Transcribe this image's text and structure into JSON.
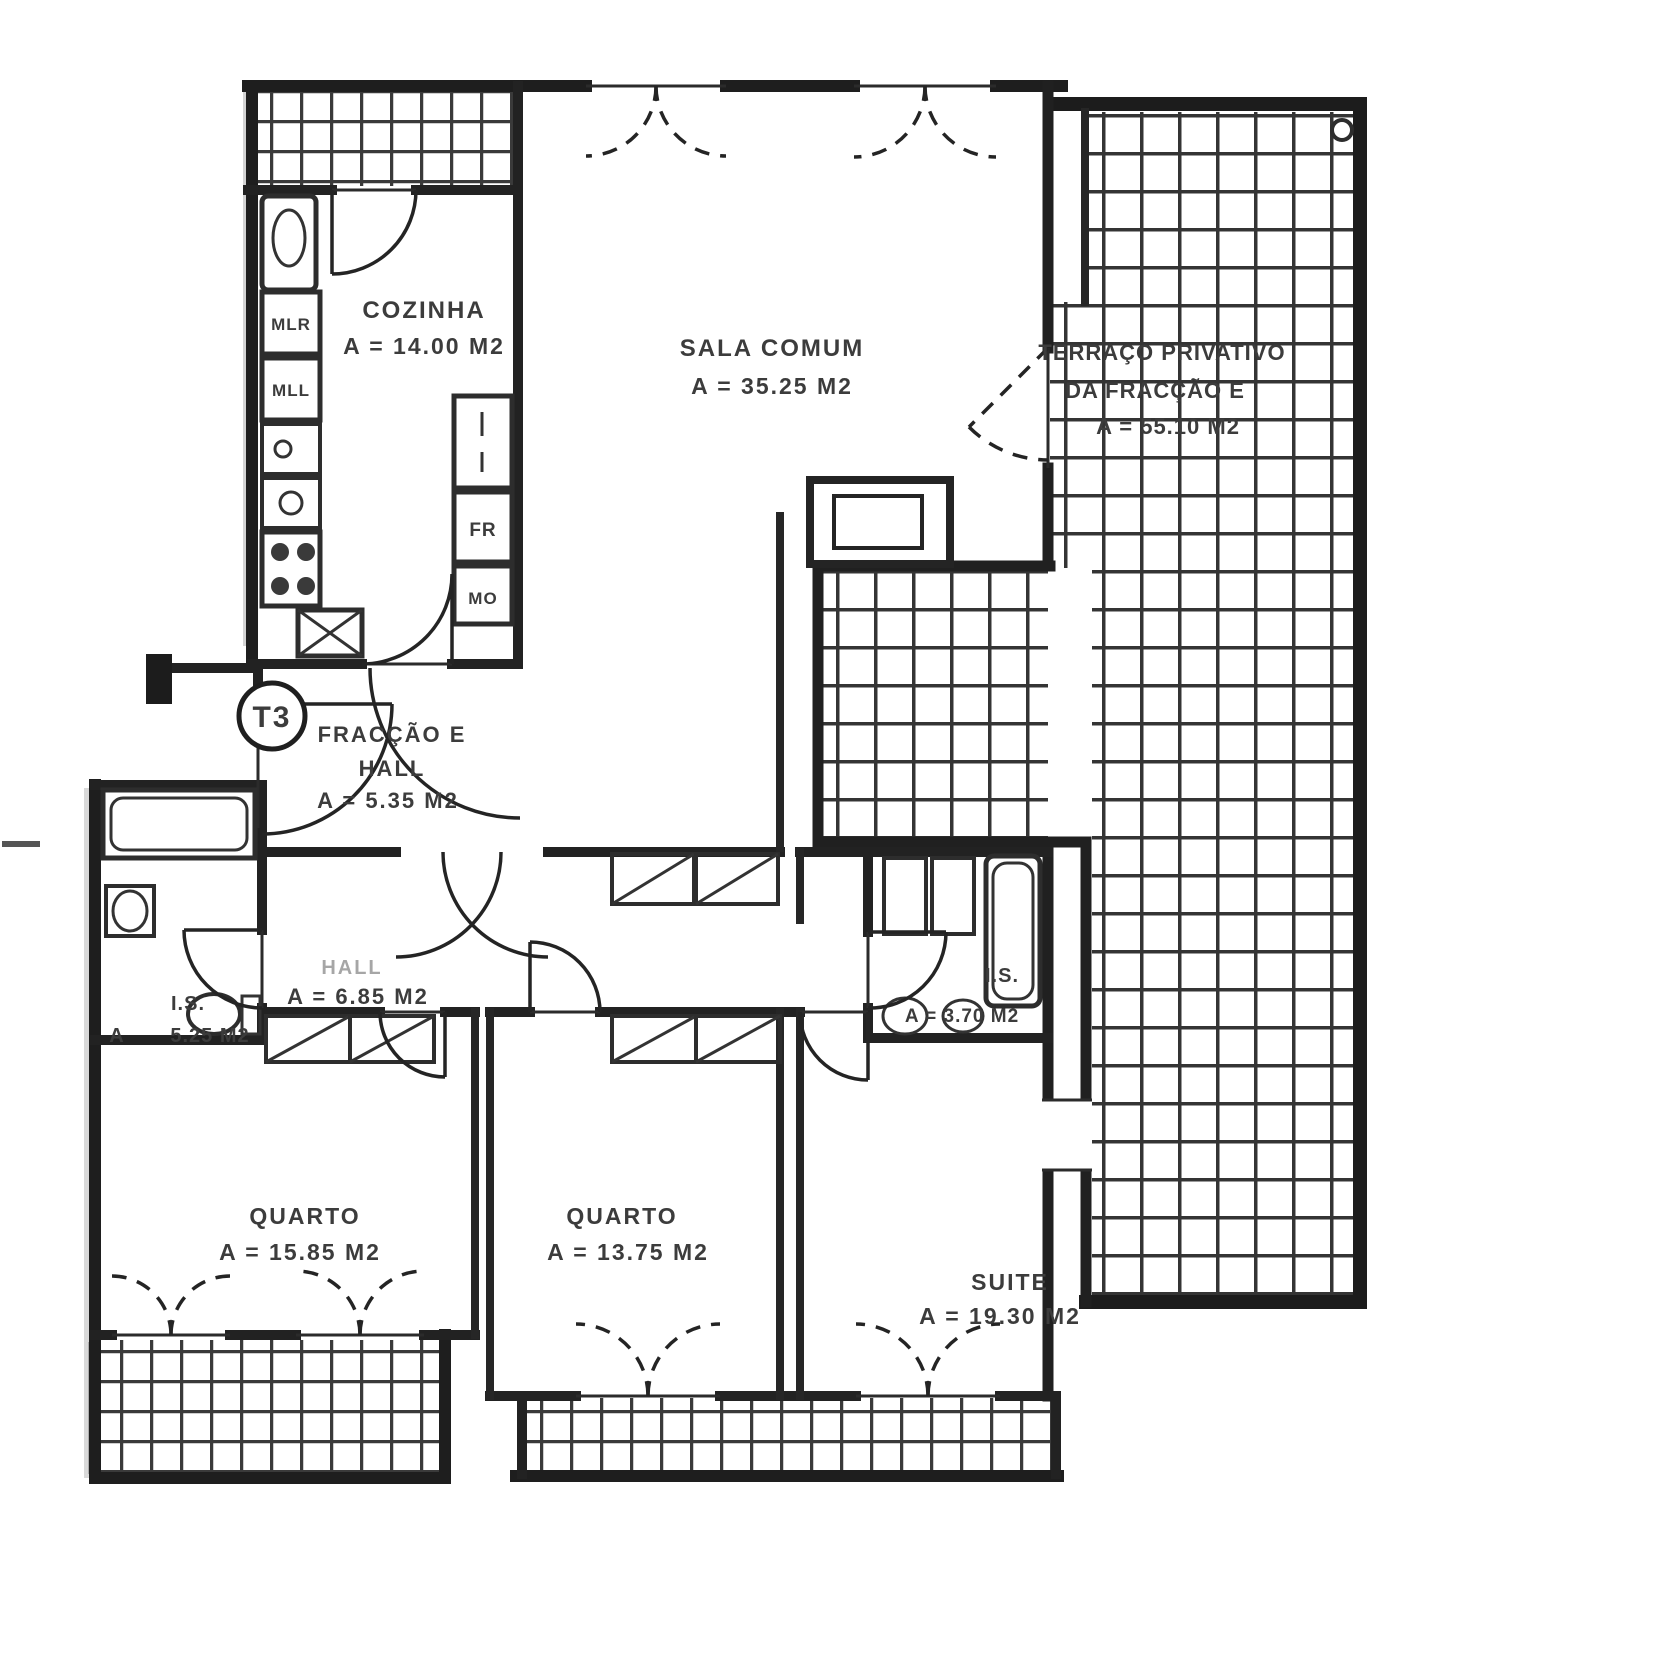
{
  "unit_badge": "T3",
  "rooms": {
    "cozinha": {
      "name": "COZINHA",
      "area": "A = 14.00 M2"
    },
    "sala": {
      "name": "SALA COMUM",
      "area": "A = 35.25 M2"
    },
    "terraco": {
      "name_line1": "TERRAÇO PRIVATIVO",
      "name_line2": "DA FRACÇÃO E",
      "area": "A = 55.10 M2"
    },
    "entry_hall": {
      "name_line1": "FRACÇÃO E",
      "name_line2": "HALL",
      "area": "A = 5.35 M2"
    },
    "hall": {
      "name": "HALL",
      "area": "A = 6.85 M2"
    },
    "is_left": {
      "name": "I.S.",
      "area_prefix": "A",
      "area": "5.25 M2"
    },
    "is_right": {
      "name": "I.S.",
      "area": "A = 3.70 M2"
    },
    "quarto1": {
      "name": "QUARTO",
      "area": "A = 15.85 M2"
    },
    "quarto2": {
      "name": "QUARTO",
      "area": "A = 13.75 M2"
    },
    "suite": {
      "name": "SUITE",
      "area": "A = 19.30 M2"
    }
  },
  "appliances": {
    "mlr": "MLR",
    "mll": "MLL",
    "fr": "FR",
    "mo": "MO"
  },
  "colors": {
    "ink": "#1f1f1f",
    "paper": "#ffffff",
    "text": "#3c3c3c"
  }
}
